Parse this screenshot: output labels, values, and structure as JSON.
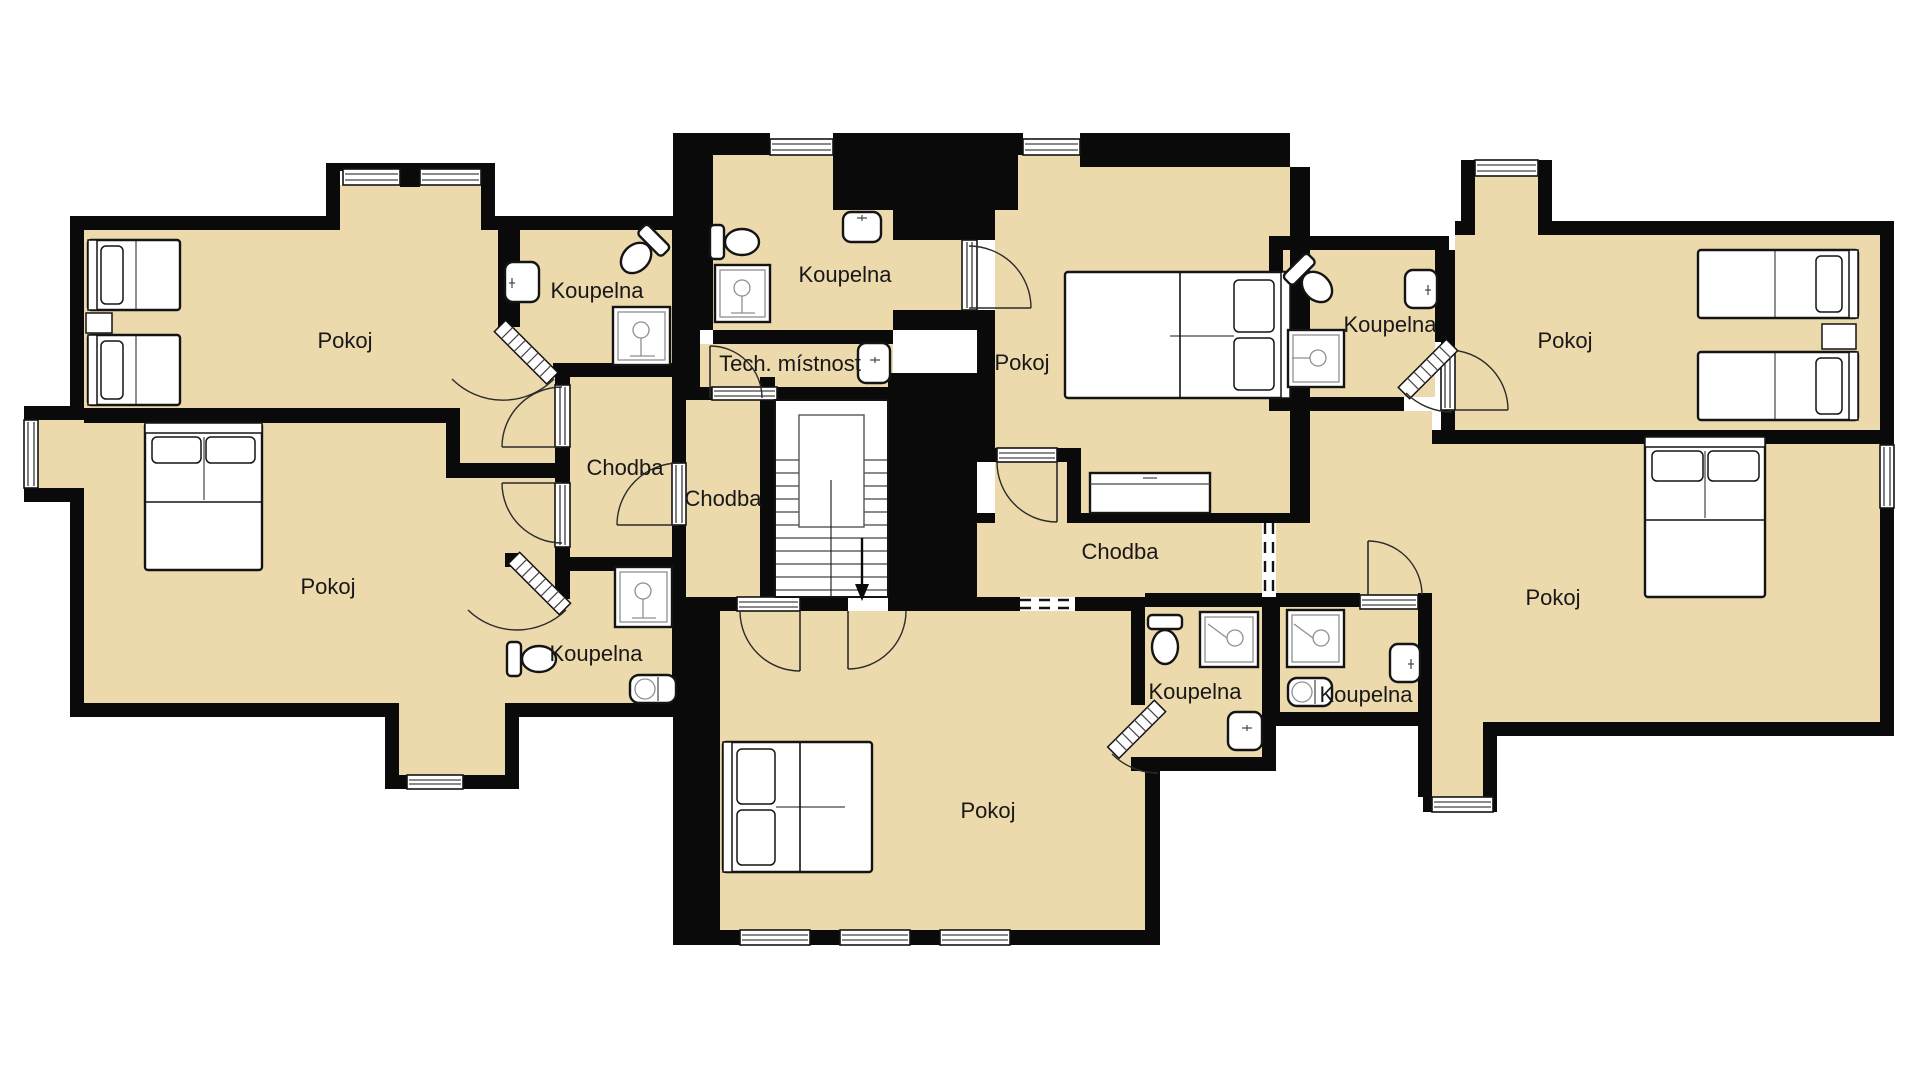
{
  "floor_plan": {
    "background_color": "#ffffff",
    "floor_color": "#ecd9ac",
    "wall_color": "#0a0a0a",
    "rooms": [
      {
        "id": "pokoj-top-left",
        "label": "Pokoj",
        "x": 345,
        "y": 348
      },
      {
        "id": "koupelna-left-1",
        "label": "Koupelna",
        "x": 597,
        "y": 298
      },
      {
        "id": "koupelna-top-center",
        "label": "Koupelna",
        "x": 845,
        "y": 282
      },
      {
        "id": "tech-mistnost",
        "label": "Tech. místnost",
        "x": 790,
        "y": 371
      },
      {
        "id": "pokoj-top-center",
        "label": "Pokoj",
        "x": 1022,
        "y": 370
      },
      {
        "id": "koupelna-right-1",
        "label": "Koupelna",
        "x": 1390,
        "y": 332
      },
      {
        "id": "pokoj-top-right",
        "label": "Pokoj",
        "x": 1565,
        "y": 348
      },
      {
        "id": "chodba-left",
        "label": "Chodba",
        "x": 625,
        "y": 475
      },
      {
        "id": "chodba-center",
        "label": "Chodba",
        "x": 723,
        "y": 506
      },
      {
        "id": "chodba-right",
        "label": "Chodba",
        "x": 1120,
        "y": 559
      },
      {
        "id": "pokoj-bottom-left",
        "label": "Pokoj",
        "x": 328,
        "y": 594
      },
      {
        "id": "koupelna-left-2",
        "label": "Koupelna",
        "x": 596,
        "y": 661
      },
      {
        "id": "koupelna-bottom-center",
        "label": "Koupelna",
        "x": 1195,
        "y": 699
      },
      {
        "id": "koupelna-right-2",
        "label": "Koupelna",
        "x": 1366,
        "y": 702
      },
      {
        "id": "pokoj-bottom-right",
        "label": "Pokoj",
        "x": 1553,
        "y": 605
      },
      {
        "id": "pokoj-bottom-center",
        "label": "Pokoj",
        "x": 988,
        "y": 818
      }
    ]
  }
}
